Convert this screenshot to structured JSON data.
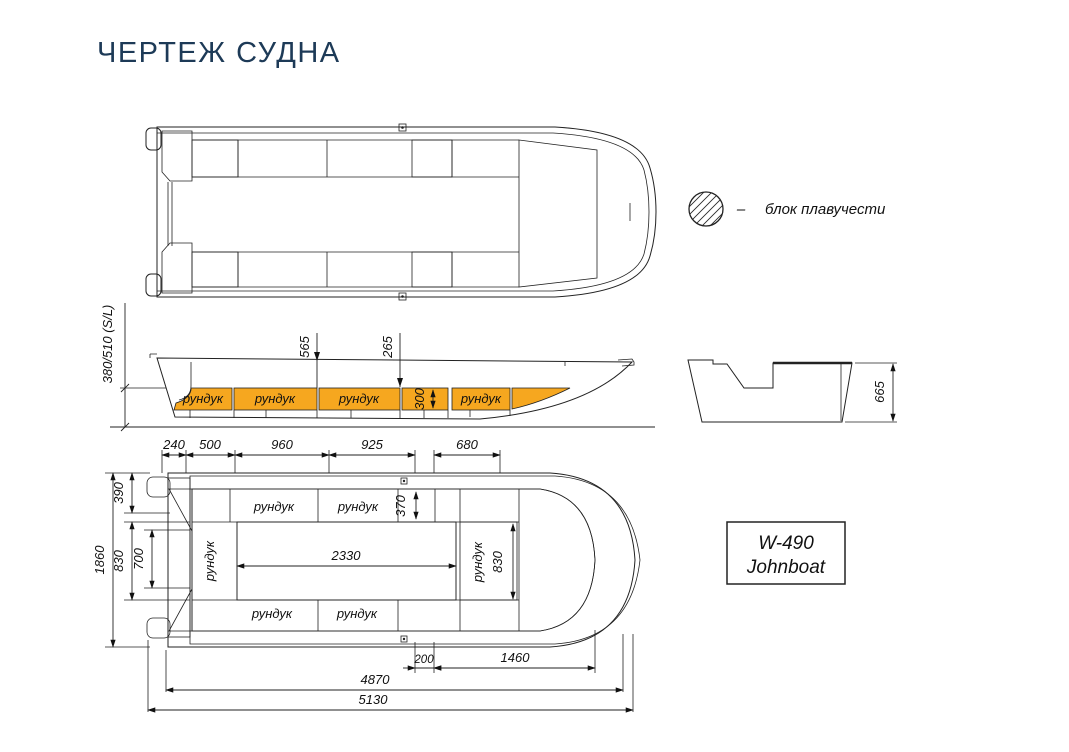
{
  "title": "ЧЕРТЕЖ СУДНА",
  "legend": {
    "symbol": "hatched-circle",
    "separator": "–",
    "label": "блок плавучести"
  },
  "model_box": {
    "model": "W-490",
    "type": "Johnboat"
  },
  "side_view": {
    "lockers": [
      "рундук",
      "рундук",
      "рундук",
      "рундук"
    ],
    "dims": {
      "transom_height": "380/510 (S/L)",
      "d565": "565",
      "d265": "265",
      "d300": "300"
    }
  },
  "transom_view": {
    "dims": {
      "d665": "665"
    }
  },
  "deck_view": {
    "dims": {
      "top": [
        "240",
        "500",
        "960",
        "925",
        "680"
      ],
      "left": [
        "390",
        "1860",
        "830",
        "700"
      ],
      "d370": "370",
      "d2330": "2330",
      "d830_right": "830",
      "bottom": [
        "200",
        "1460",
        "4870",
        "5130"
      ]
    },
    "lockers": {
      "top": [
        "рундук",
        "рундук"
      ],
      "left": "рундук",
      "right": "рундук",
      "bottom": [
        "рундук",
        "рундук"
      ]
    }
  },
  "colors": {
    "title_text": "#1D3A57",
    "locker_fill": "#F6A71F",
    "floor_fill": "#8B2A02",
    "hull_fill": "#DBDBDB",
    "hatch_band_base": "#CDCDCD",
    "outline": "#222222"
  }
}
